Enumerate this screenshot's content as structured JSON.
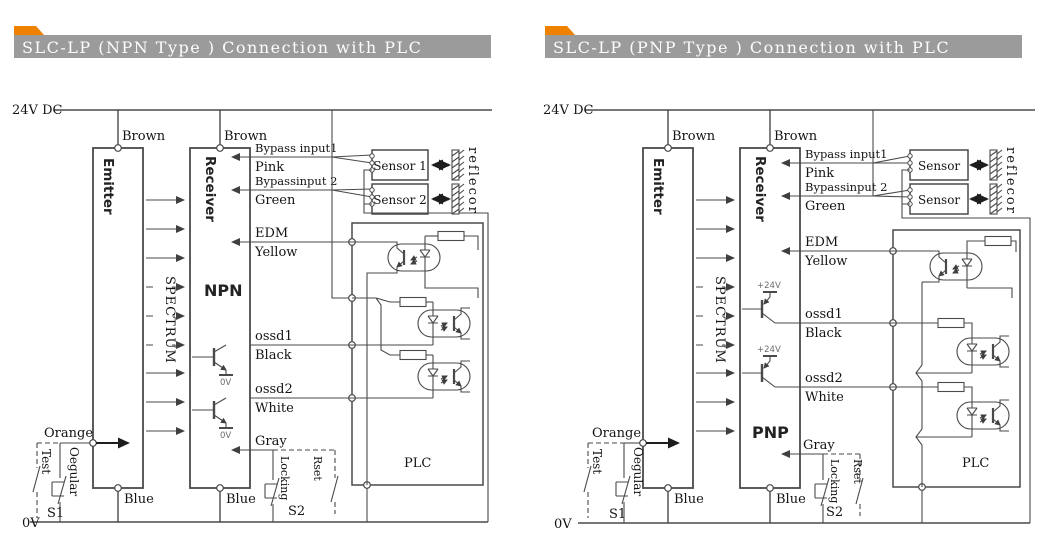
{
  "colors": {
    "background": "#ffffff",
    "titlebar_gray": "#9b9b9b",
    "tab_orange": "#ee8100",
    "line": "#4a4a4a",
    "text": "#141414",
    "title_text": "#fdfdfd"
  },
  "diagrams": [
    {
      "title": "SLC-LP (NPN Type ) Connection with PLC",
      "type": "NPN",
      "power_top": "24V DC",
      "power_bottom": "0V",
      "emitter": "Emitter",
      "receiver": "Receiver",
      "spectrum": "SPECTRUM",
      "brown_emitter": "Brown",
      "brown_receiver": "Brown",
      "blue_emitter": "Blue",
      "blue_receiver": "Blue",
      "orange": "Orange",
      "bypass1": "Bypass input1",
      "pink": "Pink",
      "bypass2": "Bypassinput 2",
      "green": "Green",
      "edm": "EDM",
      "yellow": "Yellow",
      "ossd1": "ossd1",
      "black": "Black",
      "ossd2": "ossd2",
      "white": "White",
      "gray": "Gray",
      "q1_ref": "0V",
      "q2_ref": "0V",
      "sensor1": "Sensor 1",
      "sensor2": "Sensor 2",
      "reflector": "reflecor",
      "plc": "PLC",
      "test": "Test",
      "regular": "Oegular",
      "s1": "S1",
      "locking": "Locking",
      "reset": "Rset",
      "s2": "S2"
    },
    {
      "title": "SLC-LP (PNP Type ) Connection with PLC",
      "type": "PNP",
      "power_top": "24V DC",
      "power_bottom": "0V",
      "emitter": "Emitter",
      "receiver": "Receiver",
      "spectrum": "SPECTRUM",
      "brown_emitter": "Brown",
      "brown_receiver": "Brown",
      "blue_emitter": "Blue",
      "blue_receiver": "Blue",
      "orange": "Orange",
      "bypass1": "Bypass input1",
      "pink": "Pink",
      "bypass2": "Bypassinput 2",
      "green": "Green",
      "edm": "EDM",
      "yellow": "Yellow",
      "ossd1": "ossd1",
      "black": "Black",
      "ossd2": "ossd2",
      "white": "White",
      "gray": "Gray",
      "q1_ref": "+24V",
      "q2_ref": "+24V",
      "sensor1": "Sensor",
      "sensor2": "Sensor",
      "reflector": "reflecor",
      "plc": "PLC",
      "test": "Test",
      "regular": "Oegular",
      "s1": "S1",
      "locking": "Locking",
      "reset": "Rset",
      "s2": "S2"
    }
  ]
}
